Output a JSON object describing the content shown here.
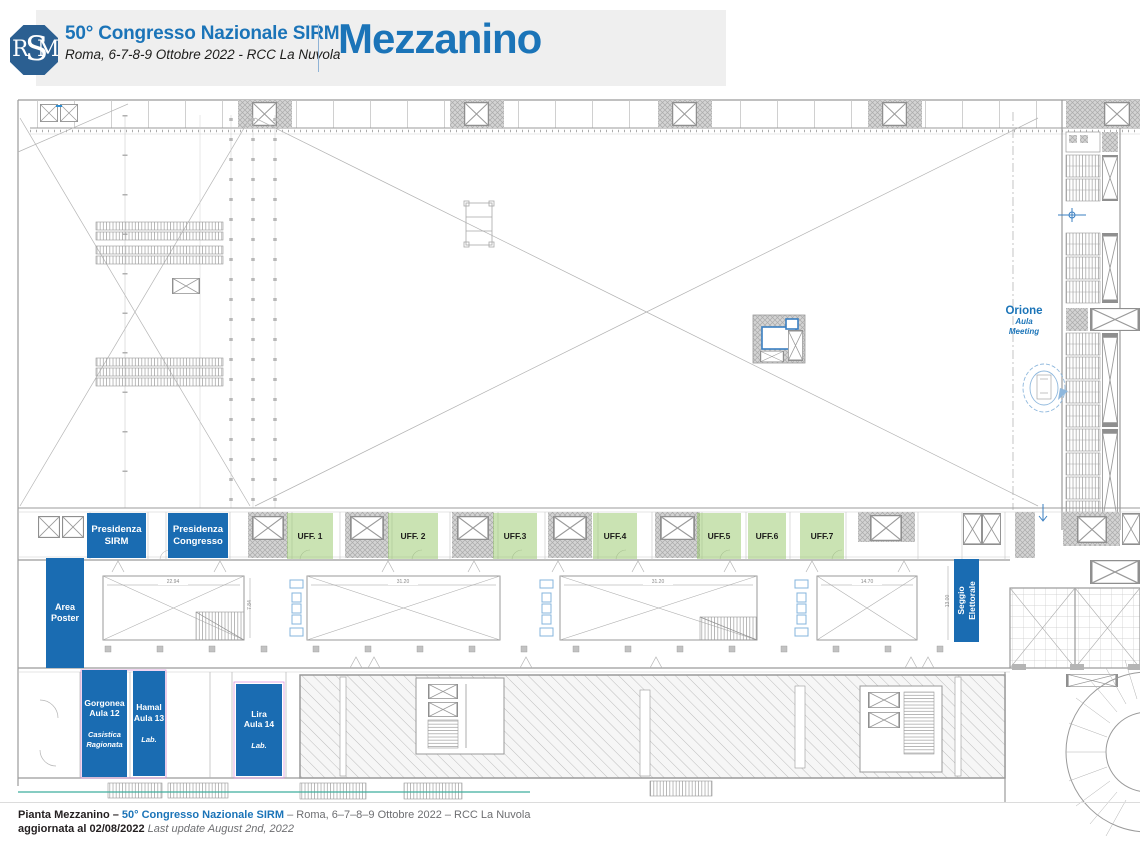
{
  "header": {
    "logo_text": "SIRM",
    "title": "50° Congresso Nazionale SIRM",
    "subtitle": "Roma, 6-7-8-9 Ottobre 2022 - RCC La Nuvola",
    "page_title": "Mezzanino"
  },
  "plan": {
    "presidenza_sirm": {
      "line1": "Presidenza",
      "line2": "SIRM"
    },
    "presidenza_congresso": {
      "line1": "Presidenza",
      "line2": "Congresso"
    },
    "offices": [
      {
        "label": "UFF. 1"
      },
      {
        "label": "UFF. 2"
      },
      {
        "label": "UFF.3"
      },
      {
        "label": "UFF.4"
      },
      {
        "label": "UFF.5"
      },
      {
        "label": "UFF.6"
      },
      {
        "label": "UFF.7"
      }
    ],
    "area_poster": {
      "line1": "Area",
      "line2": "Poster"
    },
    "seggio": {
      "line1": "Seggio",
      "line2": "Elettorale"
    },
    "aule": [
      {
        "name1": "Gorgonea",
        "name2": "Aula 12",
        "sub1": "Casistica",
        "sub2": "Ragionata"
      },
      {
        "name1": "Hamal",
        "name2": "Aula 13",
        "sub1": "Lab.",
        "sub2": ""
      },
      {
        "name1": "Lira",
        "name2": "Aula 14",
        "sub1": "Lab.",
        "sub2": ""
      }
    ],
    "orione": {
      "name": "Orione",
      "sub1": "Aula",
      "sub2": "Meeting"
    },
    "dimensions": {
      "r1_w": "22.94",
      "r1_h": "7.84",
      "r2_w": "31.20",
      "r3_w": "31.20",
      "r4_w": "14.70",
      "right_h": "13.00"
    }
  },
  "footer": {
    "bold1": "Pianta Mezzanino – ",
    "link": "50° Congresso Nazionale SIRM",
    "rest": " – Roma, 6–7–8–9 Ottobre 2022 – RCC La Nuvola",
    "bold2": "aggiornata al 02/08/2022 ",
    "italic": "Last update August 2nd, 2022"
  },
  "colors": {
    "accent_blue": "#1a6cb2",
    "title_blue": "#1b74b8",
    "office_green": "#b9db9e"
  }
}
